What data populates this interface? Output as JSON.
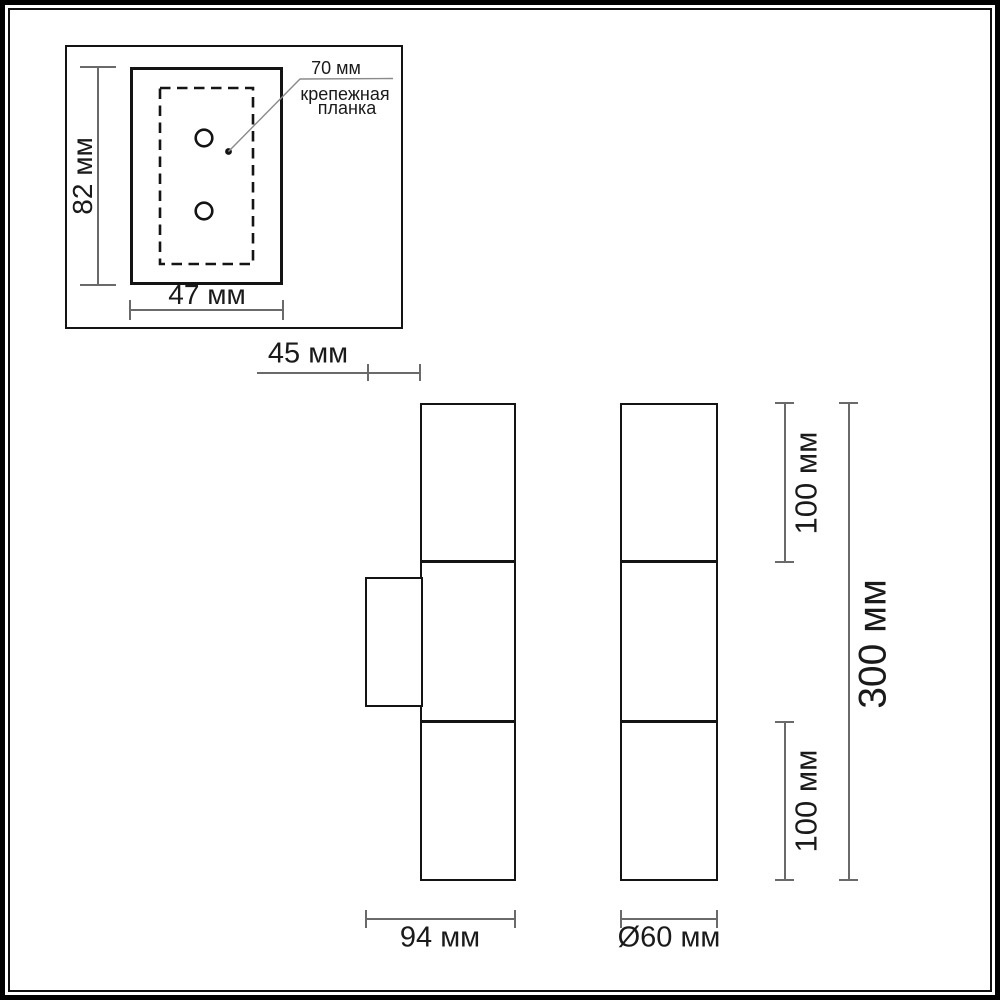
{
  "drawing": {
    "type": "wall-lamp dimensional drawing",
    "labels": {
      "plate_height": "82 мм",
      "plate_width": "47 мм",
      "hole_spacing": "70 мм",
      "callout_line1": "крепежная",
      "callout_line2": "планка",
      "bracket_depth": "45 мм",
      "body_depth": "94 мм",
      "diameter": "Ø60 мм",
      "segment_top": "100 мм",
      "segment_bottom": "100 мм",
      "total_height": "300 мм"
    },
    "dimensions_mm": {
      "mounting_plate_height": 82,
      "mounting_plate_width": 47,
      "mounting_hole_spacing": 70,
      "wall_bracket_depth": 45,
      "body_depth": 94,
      "shade_diameter": 60,
      "shade_segment_length": 100,
      "total_height": 300
    },
    "colors": {
      "outline": "#141414",
      "dimension_line": "#6a6a6a",
      "leader_line": "#8a8a8a",
      "text": "#1a1a1a",
      "background": "#ffffff"
    }
  }
}
